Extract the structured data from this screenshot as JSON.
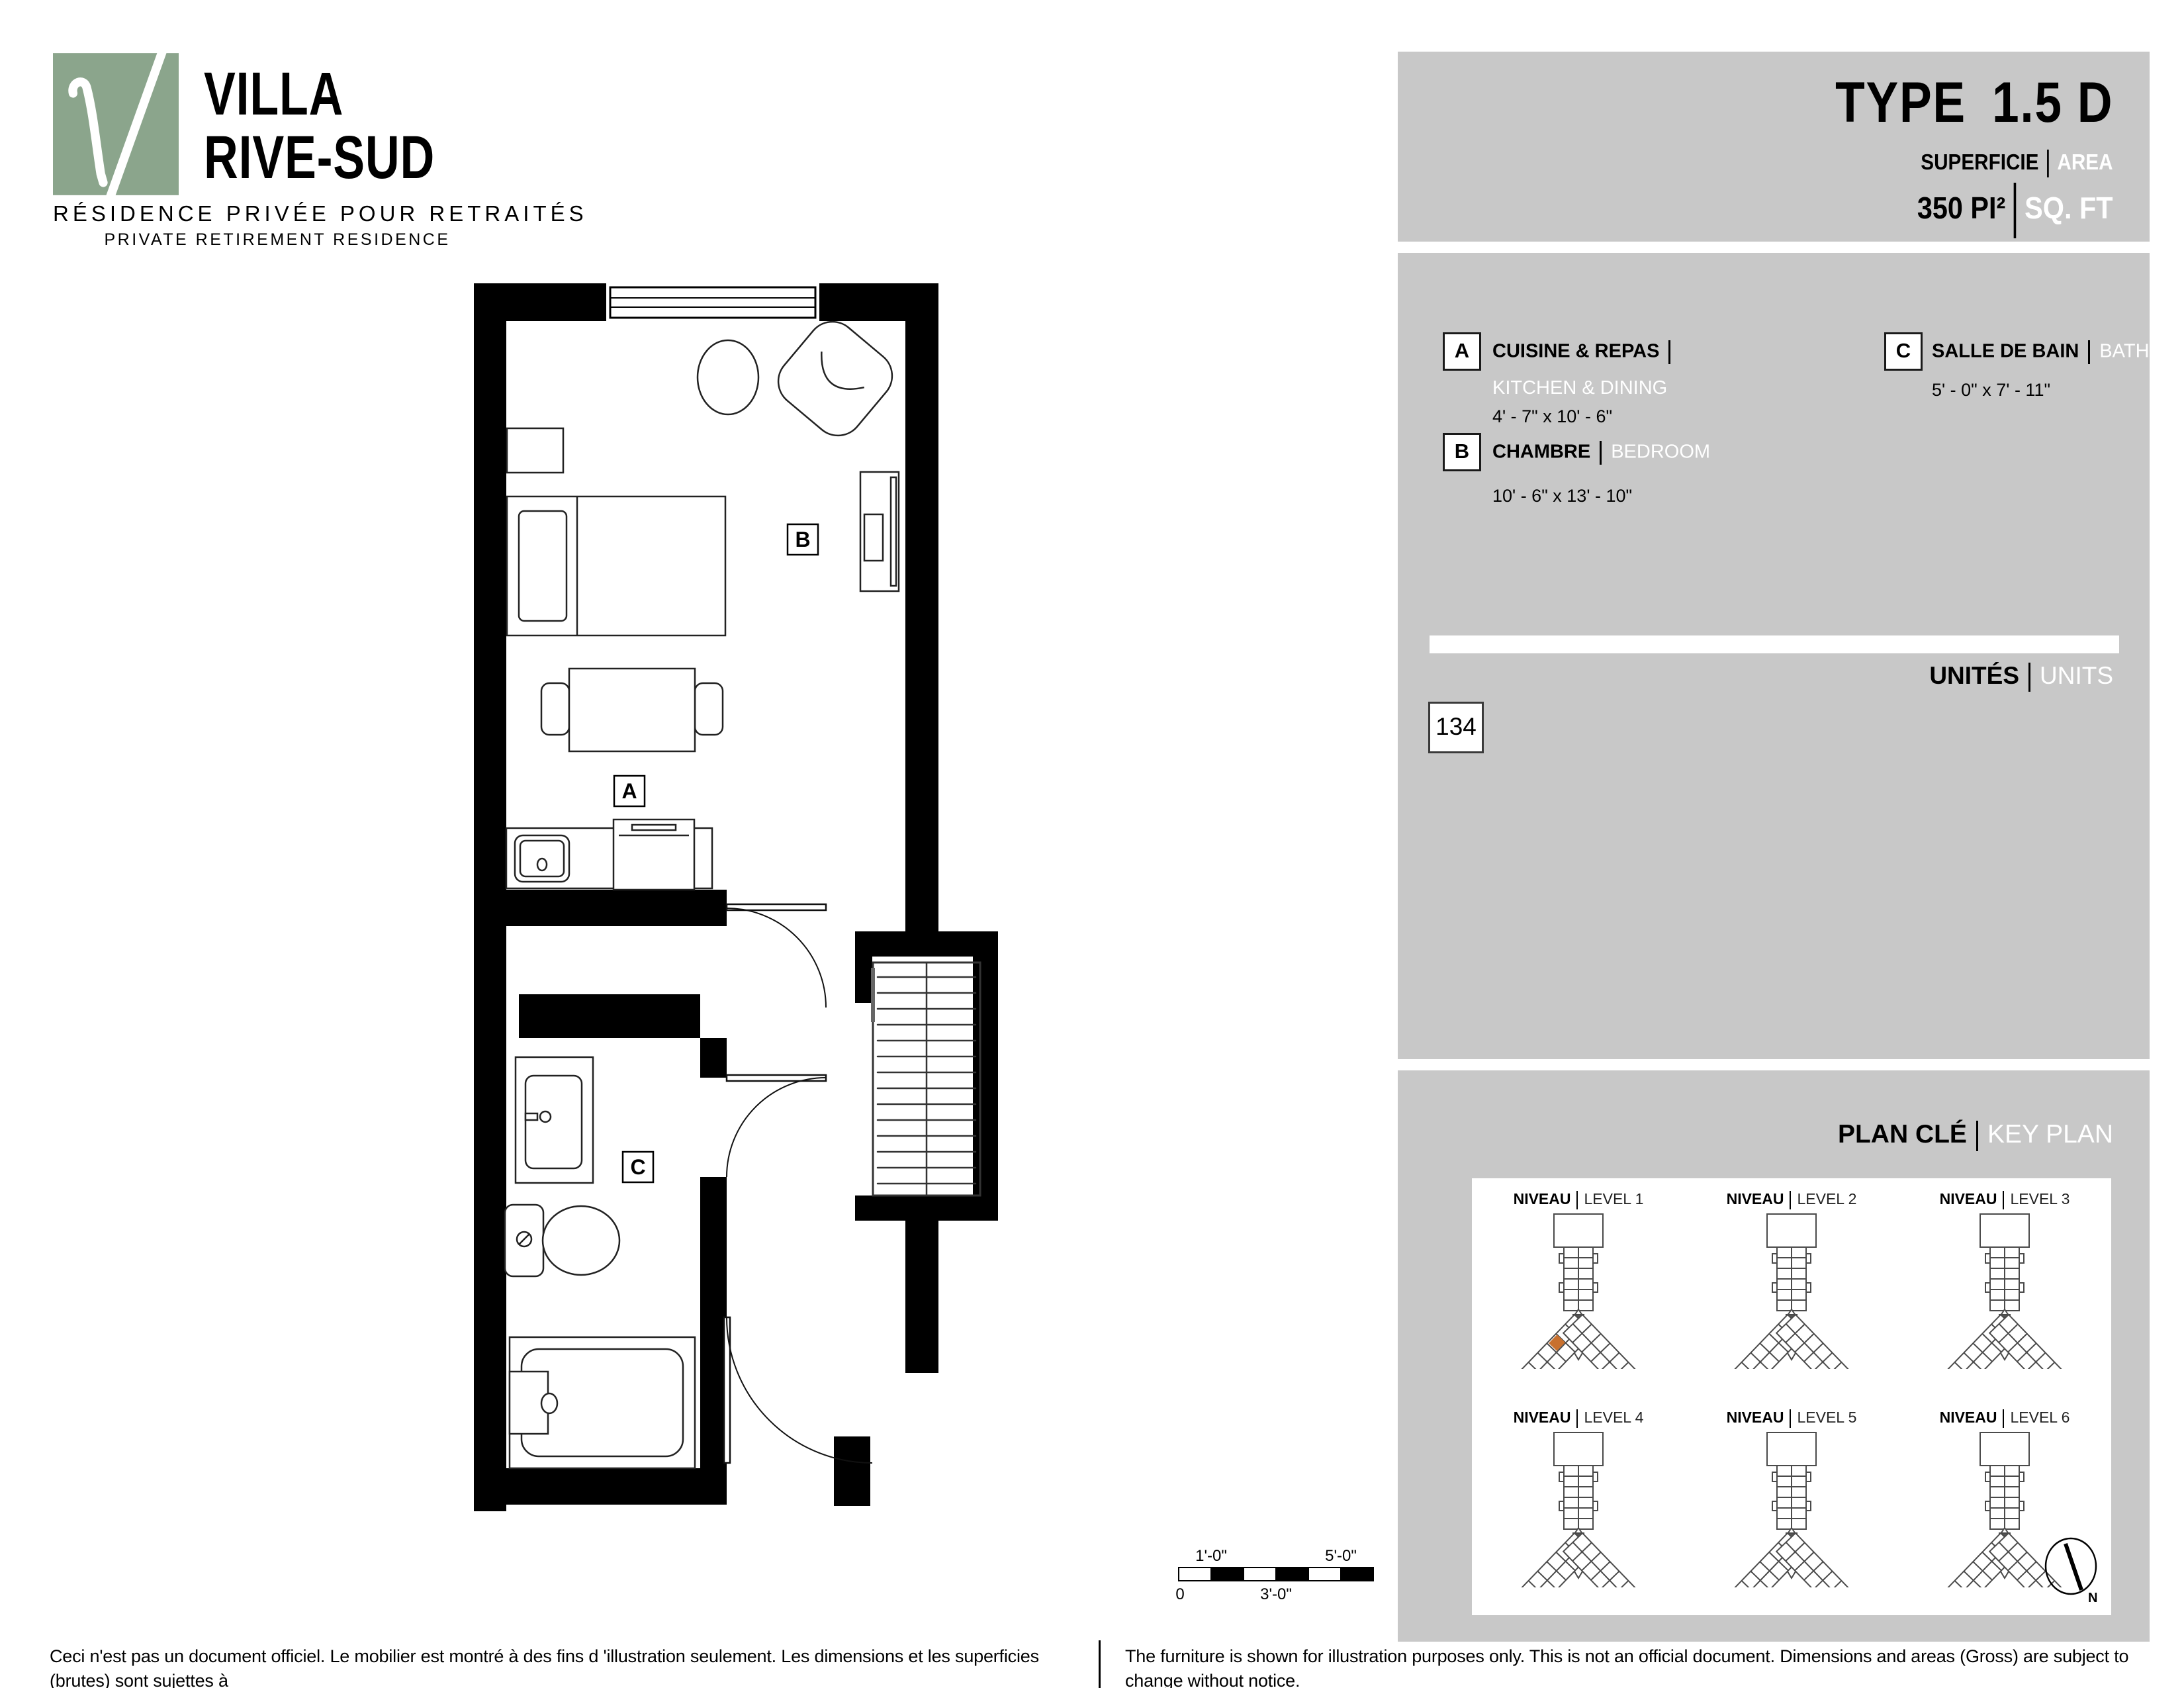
{
  "logo": {
    "name_line1": "VILLA",
    "name_line2": "RIVE-SUD",
    "tagline_fr": "RÉSIDENCE PRIVÉE POUR RETRAITÉS",
    "tagline_en": "PRIVATE RETIREMENT RESIDENCE",
    "brand_green": "#8BA58C"
  },
  "header": {
    "type_label": "TYPE",
    "type_value": "1.5 D",
    "area_label_fr": "SUPERFICIE",
    "area_label_en": "AREA",
    "area_value_fr": "350 PI²",
    "area_value_en": "SQ. FT"
  },
  "legend": {
    "items": [
      {
        "key": "A",
        "name_fr": "CUISINE & REPAS",
        "name_en": "KITCHEN & DINING",
        "dims": "4' - 7\" x 10' - 6\""
      },
      {
        "key": "B",
        "name_fr": "CHAMBRE",
        "name_en": "BEDROOM",
        "dims": "10' - 6\" x 13' - 10\""
      },
      {
        "key": "C",
        "name_fr": "SALLE DE BAIN",
        "name_en": "BATHROOM",
        "dims": "5' - 0\" x 7' - 11\""
      }
    ],
    "units_label_fr": "UNITÉS",
    "units_label_en": "UNITS",
    "unit_number": "134"
  },
  "keyplan": {
    "title_fr": "PLAN CLÉ",
    "title_en": "KEY PLAN",
    "levels": [
      {
        "fr": "NIVEAU",
        "en": "LEVEL 1"
      },
      {
        "fr": "NIVEAU",
        "en": "LEVEL 2"
      },
      {
        "fr": "NIVEAU",
        "en": "LEVEL 3"
      },
      {
        "fr": "NIVEAU",
        "en": "LEVEL 4"
      },
      {
        "fr": "NIVEAU",
        "en": "LEVEL 5"
      },
      {
        "fr": "NIVEAU",
        "en": "LEVEL 6"
      }
    ],
    "highlight_color": "#C8702E",
    "north_label": "N"
  },
  "scalebar": {
    "above_left": "1'-0\"",
    "above_right": "5'-0\"",
    "below_left": "0",
    "below_mid": "3'-0\""
  },
  "footer": {
    "fr_line1": "Ceci n'est pas un document officiel.  Le mobilier est montré à des fins d 'illustration seulement.  Les dimensions et les superficies (brutes) sont sujettes à",
    "fr_line2": "changement sans préavis. La superficie et la position des éléments structuraux peuvent varier en fonction de l'emplacement de l'unité dans le bâtiment.",
    "en_line1": "The furniture is shown for illustration purposes only.  This is not an official document.  Dimensions and areas (Gross) are subject to change without notice.",
    "en_line2": "Area and position of structural elements may vary depending of location of unit in building."
  }
}
